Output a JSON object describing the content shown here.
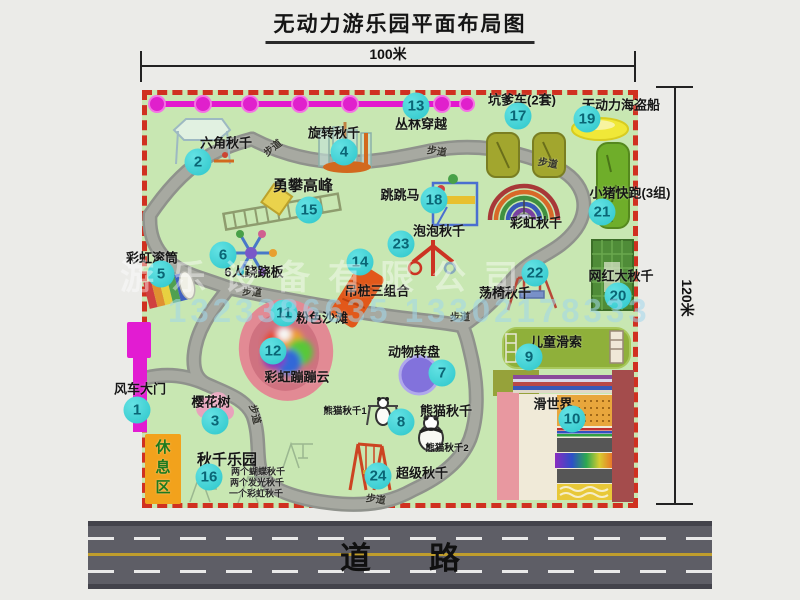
{
  "title": "无动力游乐园平面布局图",
  "dimensions": {
    "top": "100米",
    "right": "120米"
  },
  "road": {
    "label": "道路"
  },
  "watermark": {
    "company": "游乐设备有限公司",
    "phone": "1323386635 13302178333"
  },
  "colors": {
    "park_ground": "#c8e7b2",
    "park_border": "#d03020",
    "badge": "#2cc6ca",
    "chain": "#e020cc",
    "gate": "#e21cd2",
    "rest_area": "#f2a21c"
  },
  "park": {
    "attractions": [
      {
        "num": "1",
        "name": "风车大门",
        "badge": {
          "x": 137,
          "y": 410
        },
        "label": {
          "x": 140,
          "y": 388,
          "cls": "main"
        }
      },
      {
        "num": "2",
        "name": "六角秋千",
        "badge": {
          "x": 198,
          "y": 162
        },
        "label": {
          "x": 226,
          "y": 142,
          "cls": "main"
        }
      },
      {
        "num": "3",
        "name": "樱花树",
        "badge": {
          "x": 215,
          "y": 421
        },
        "label": {
          "x": 211,
          "y": 401,
          "cls": "main"
        }
      },
      {
        "num": "4",
        "name": "旋转秋千",
        "badge": {
          "x": 344,
          "y": 152
        },
        "label": {
          "x": 334,
          "y": 132,
          "cls": "main"
        }
      },
      {
        "num": "5",
        "name": "彩虹滚筒",
        "badge": {
          "x": 161,
          "y": 274
        },
        "label": {
          "x": 152,
          "y": 257,
          "cls": "main"
        }
      },
      {
        "num": "6",
        "name": "6人跷跷板",
        "badge": {
          "x": 223,
          "y": 255
        },
        "label": {
          "x": 254,
          "y": 271,
          "cls": "main"
        }
      },
      {
        "num": "7",
        "name": "动物转盘",
        "badge": {
          "x": 442,
          "y": 373
        },
        "label": {
          "x": 414,
          "y": 351,
          "cls": "main"
        }
      },
      {
        "num": "8",
        "name": "熊猫秋千",
        "badge": {
          "x": 401,
          "y": 422
        },
        "label": {
          "x": 446,
          "y": 410,
          "cls": "main"
        }
      },
      {
        "num": "9",
        "name": "儿童滑索",
        "badge": {
          "x": 529,
          "y": 357
        },
        "label": {
          "x": 556,
          "y": 341,
          "cls": "main"
        }
      },
      {
        "num": "10",
        "name": "滑世界",
        "badge": {
          "x": 572,
          "y": 419
        },
        "label": {
          "x": 553,
          "y": 403,
          "cls": "main"
        }
      },
      {
        "num": "11",
        "name": "粉色沙滩",
        "badge": {
          "x": 284,
          "y": 313
        },
        "label": {
          "x": 322,
          "y": 317,
          "cls": "main"
        }
      },
      {
        "num": "12",
        "name": "彩虹蹦蹦云",
        "badge": {
          "x": 273,
          "y": 351
        },
        "label": {
          "x": 297,
          "y": 376,
          "cls": "main"
        }
      },
      {
        "num": "13",
        "name": "丛林穿越",
        "badge": {
          "x": 416,
          "y": 106
        },
        "label": {
          "x": 421,
          "y": 123,
          "cls": "main"
        }
      },
      {
        "num": "14",
        "name": "吊桩三组合",
        "badge": {
          "x": 360,
          "y": 262
        },
        "label": {
          "x": 377,
          "y": 290,
          "cls": "main"
        }
      },
      {
        "num": "15",
        "name": "勇攀高峰",
        "badge": {
          "x": 309,
          "y": 210
        },
        "label": {
          "x": 303,
          "y": 185,
          "cls": "big"
        }
      },
      {
        "num": "16",
        "name": "秋千乐园",
        "badge": {
          "x": 209,
          "y": 477
        },
        "label": {
          "x": 227,
          "y": 459,
          "cls": "big"
        }
      },
      {
        "num": "17",
        "name": "坑爹车(2套)",
        "badge": {
          "x": 518,
          "y": 116
        },
        "label": {
          "x": 522,
          "y": 99,
          "cls": "main"
        }
      },
      {
        "num": "18",
        "name": "跳跳马",
        "badge": {
          "x": 434,
          "y": 200
        },
        "label": {
          "x": 400,
          "y": 194,
          "cls": "main"
        }
      },
      {
        "num": "19",
        "name": "无动力海盗船",
        "badge": {
          "x": 587,
          "y": 119
        },
        "label": {
          "x": 621,
          "y": 104,
          "cls": "main"
        }
      },
      {
        "num": "20",
        "name": "网红大秋千",
        "badge": {
          "x": 618,
          "y": 296
        },
        "label": {
          "x": 621,
          "y": 275,
          "cls": "main"
        }
      },
      {
        "num": "21",
        "name": "小猪快跑(3组)",
        "badge": {
          "x": 602,
          "y": 212
        },
        "label": {
          "x": 630,
          "y": 192,
          "cls": "main"
        }
      },
      {
        "num": "22",
        "name": "荡椅秋千",
        "badge": {
          "x": 535,
          "y": 273
        },
        "label": {
          "x": 505,
          "y": 292,
          "cls": "main"
        }
      },
      {
        "num": "23",
        "name": "泡泡秋千",
        "badge": {
          "x": 401,
          "y": 244
        },
        "label": {
          "x": 439,
          "y": 230,
          "cls": "main"
        }
      },
      {
        "num": "24",
        "name": "超级秋千",
        "badge": {
          "x": 378,
          "y": 476
        },
        "label": {
          "x": 422,
          "y": 472,
          "cls": "main"
        }
      }
    ],
    "extra_labels": [
      {
        "name": "rainbow-swing-label",
        "text": "彩虹秋千",
        "x": 536,
        "y": 222,
        "cls": "main"
      },
      {
        "name": "panda-swing-1-label",
        "text": "熊猫秋千1",
        "x": 345,
        "y": 410,
        "cls": "small"
      },
      {
        "name": "panda-swing-2-label",
        "text": "熊猫秋千2",
        "x": 447,
        "y": 447,
        "cls": "small"
      },
      {
        "name": "swing-park-note-1",
        "text": "两个蝴蝶秋千",
        "x": 258,
        "y": 471,
        "cls": "tiny"
      },
      {
        "name": "swing-park-note-2",
        "text": "两个发光秋千",
        "x": 257,
        "y": 482,
        "cls": "tiny"
      },
      {
        "name": "swing-park-note-3",
        "text": "一个彩虹秋千",
        "x": 256,
        "y": 493,
        "cls": "tiny"
      },
      {
        "name": "rest-area-label",
        "text": "休息区",
        "x": 162,
        "y": 469,
        "cls": "vert"
      }
    ],
    "trail_labels": [
      {
        "text": "步道",
        "x": 272,
        "y": 147,
        "rot": -38
      },
      {
        "text": "步道",
        "x": 437,
        "y": 150,
        "rot": 8
      },
      {
        "text": "步道",
        "x": 548,
        "y": 162,
        "rot": 10
      },
      {
        "text": "步道",
        "x": 252,
        "y": 291,
        "rot": 4
      },
      {
        "text": "步道",
        "x": 460,
        "y": 316,
        "rot": 0
      },
      {
        "text": "步道",
        "x": 256,
        "y": 414,
        "rot": 75
      },
      {
        "text": "步道",
        "x": 376,
        "y": 498,
        "rot": 8
      }
    ]
  }
}
